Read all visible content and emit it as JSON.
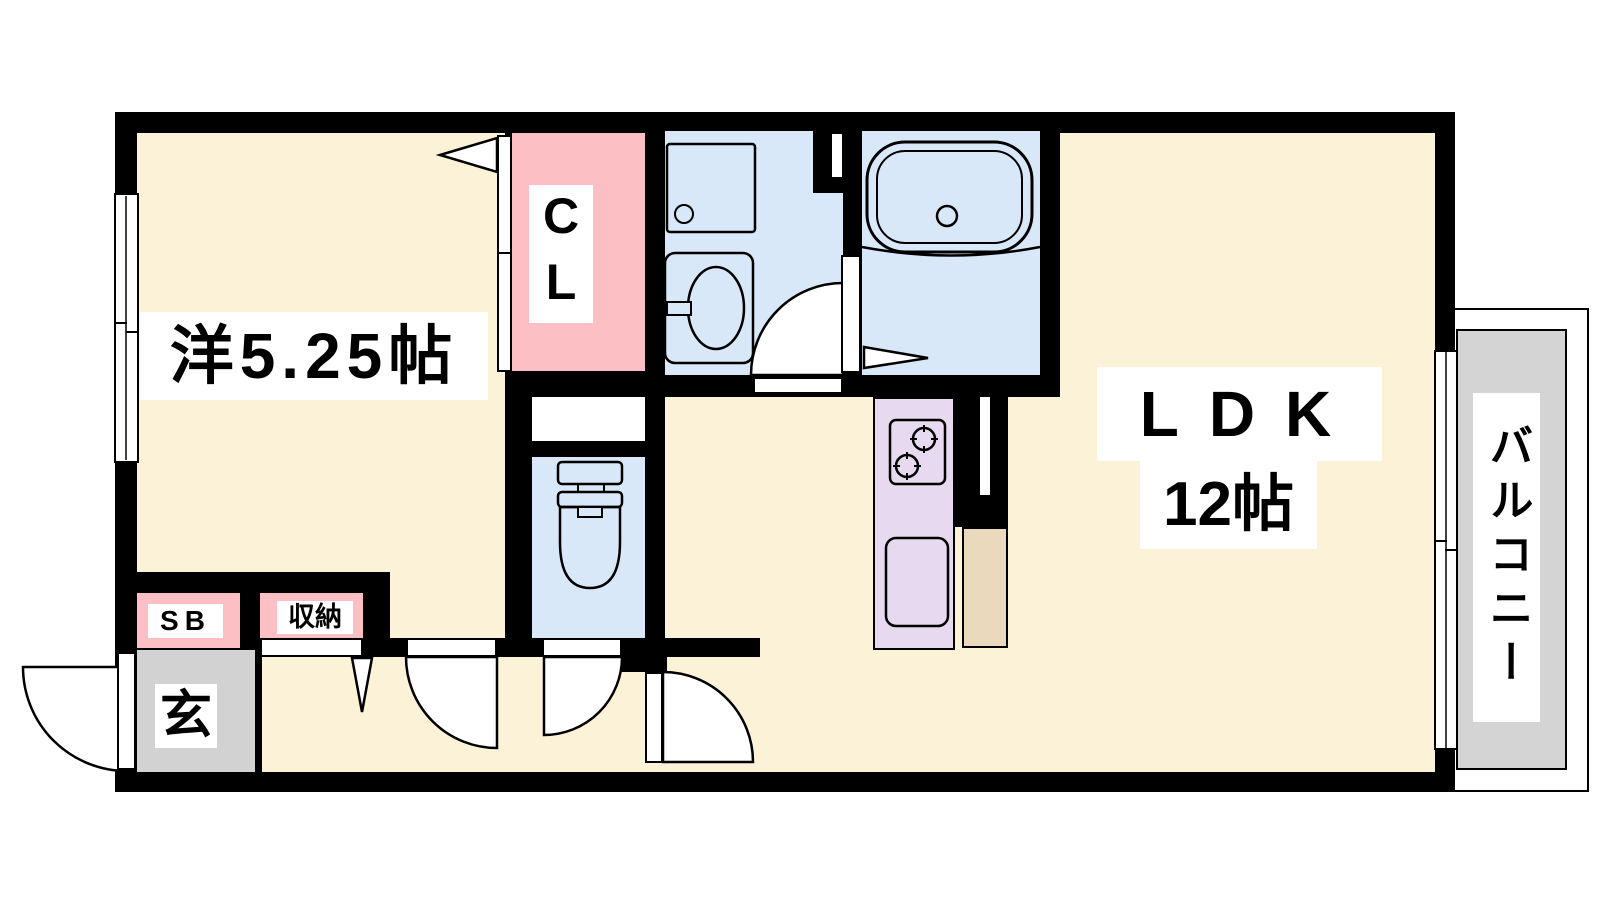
{
  "plan_title": "1LDK apartment floor plan",
  "rooms": {
    "western": {
      "label": "洋5.25帖"
    },
    "closet": {
      "label": "CL"
    },
    "ldk": {
      "label": "LDK",
      "size": "12帖"
    },
    "balcony": {
      "label": "バルコニー"
    },
    "shoe_box": {
      "label": "SB"
    },
    "storage": {
      "label": "収納"
    },
    "entrance": {
      "label": "玄"
    }
  },
  "colors": {
    "wall": "#000000",
    "room_floor": "#FCF2D8",
    "closet_pink": "#FBBFC4",
    "wet_area_blue": "#D9E8F8",
    "kitchen_lavender": "#E7D9F0",
    "kitchen_tan": "#EAD9BD",
    "entrance_gray": "#D2D2D2",
    "balcony_gray": "#D4D4D4",
    "label_bg": "#FFFFFF"
  },
  "fixtures": [
    "washing-machine-pan",
    "washroom-sink",
    "bathtub",
    "toilet",
    "stove-two-burner",
    "kitchen-sink"
  ],
  "doors": [
    "entrance-swing-door",
    "western-room-swing-door",
    "toilet-swing-door",
    "ldk-swing-door",
    "washroom-swing-door",
    "closet-folding-door",
    "storage-folding-door",
    "bath-folding-door"
  ],
  "windows": [
    "left-sliding-window",
    "balcony-sliding-window"
  ]
}
